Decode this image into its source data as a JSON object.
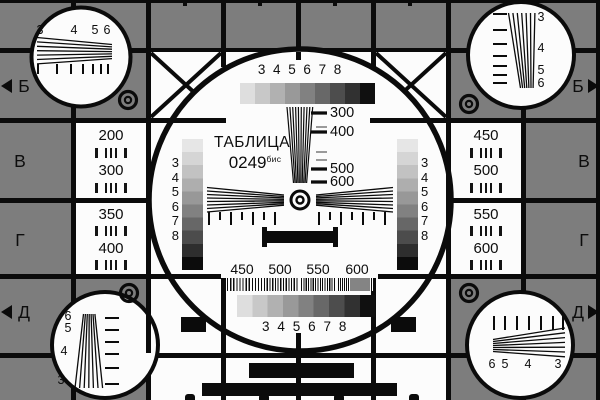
{
  "card": {
    "name": "television-test-pattern",
    "colors": {
      "background_gray": "#7d7d7d",
      "ink_black": "#0b0b0b",
      "card_white": "#fcfcfc",
      "grayscale_strip_steps": [
        "#dedede",
        "#c8c8c8",
        "#b1b1b1",
        "#999999",
        "#818181",
        "#686868",
        "#4d4d4d",
        "#313131",
        "#101010"
      ],
      "grayscale_column_steps": [
        "#e6e6e6",
        "#d5d5d5",
        "#c2c2c2",
        "#aeaeae",
        "#989898",
        "#818181",
        "#676767",
        "#4c4c4c",
        "#2e2e2e",
        "#0c0c0c"
      ]
    }
  },
  "center": {
    "title": "ТАБЛИЦА",
    "code": "0249",
    "code_suffix": "бис",
    "top_scale_labels": [
      "3",
      "4",
      "5",
      "6",
      "7",
      "8"
    ],
    "wedge_marks": [
      "300",
      "400",
      "500",
      "600"
    ],
    "left_gray_labels": [
      "3",
      "4",
      "5",
      "6",
      "7",
      "8"
    ],
    "right_gray_labels": [
      "3",
      "4",
      "5",
      "6",
      "7",
      "8"
    ],
    "burst_labels": [
      "450",
      "500",
      "550",
      "600"
    ],
    "bottom_scale_labels": [
      "3",
      "4",
      "5",
      "6",
      "7",
      "8"
    ]
  },
  "side_cells": {
    "left": [
      [
        "200",
        "300"
      ],
      [
        "350",
        "400"
      ]
    ],
    "right": [
      [
        "450",
        "500"
      ],
      [
        "550",
        "600"
      ]
    ]
  },
  "rows": {
    "left": [
      "Б",
      "В",
      "Г",
      "Д"
    ],
    "right": [
      "Б",
      "В",
      "Г",
      "Д"
    ]
  },
  "corners": {
    "tl": [
      "3",
      "4",
      "5",
      "6"
    ],
    "tr": [
      "3",
      "4",
      "5",
      "6"
    ],
    "bl": [
      "6",
      "5",
      "4",
      "3"
    ],
    "br": [
      "6",
      "5",
      "4",
      "3"
    ]
  }
}
